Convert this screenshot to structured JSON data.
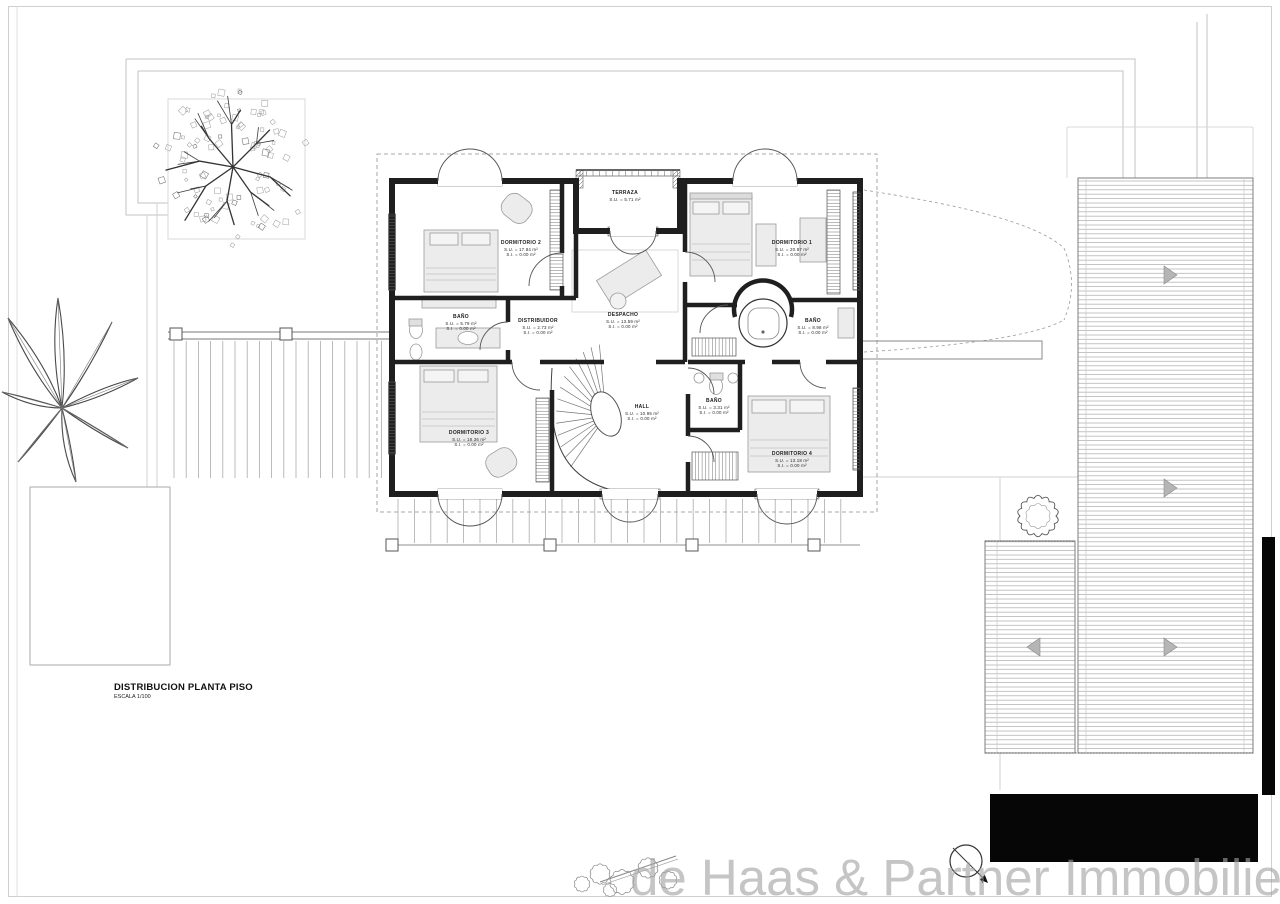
{
  "title_block": {
    "title": "DISTRIBUCION PLANTA PISO",
    "scale": "ESCALA 1/100"
  },
  "watermark": "de Haas & Partner Immobilien",
  "compass": {
    "label": "N"
  },
  "rooms": [
    {
      "name": "TERRAZA",
      "su": "S.U. = 5.71 m²",
      "si": ""
    },
    {
      "name": "DORMITORIO 2",
      "su": "S.U. = 17.84 m²",
      "si": "S.I. = 0.00 m²"
    },
    {
      "name": "DORMITORIO 1",
      "su": "S.U. = 20.87 m²",
      "si": "S.I. = 0.00 m²"
    },
    {
      "name": "BAÑO",
      "su": "S.U. = 5.79 m²",
      "si": "S.I. = 0.00 m²"
    },
    {
      "name": "DISTRIBUIDOR",
      "su": "S.U. = 2.73 m²",
      "si": "S.I. = 0.00 m²"
    },
    {
      "name": "DESPACHO",
      "su": "S.U. = 13.59 m²",
      "si": "S.I. = 0.00 m²"
    },
    {
      "name": "BAÑO",
      "su": "S.U. = 8.98 m²",
      "si": "S.I. = 0.00 m²"
    },
    {
      "name": "DORMITORIO 3",
      "su": "S.U. = 18.36 m²",
      "si": "S.I. = 0.00 m²"
    },
    {
      "name": "HALL",
      "su": "S.U. = 10.95 m²",
      "si": "S.I. = 0.00 m²"
    },
    {
      "name": "BAÑO",
      "su": "S.U. = 3.31 m²",
      "si": "S.I. = 0.00 m²"
    },
    {
      "name": "DORMITORIO 4",
      "su": "S.U. = 13.18 m²",
      "si": "S.I. = 0.00 m²"
    }
  ],
  "colors": {
    "ink": "#1f1f1f",
    "site_line": "#bfbfbf",
    "deck_line": "#a9a9a9",
    "furniture_fill": "#ececec",
    "watermark": "rgba(162,162,162,0.62)",
    "mask": "#000000"
  }
}
